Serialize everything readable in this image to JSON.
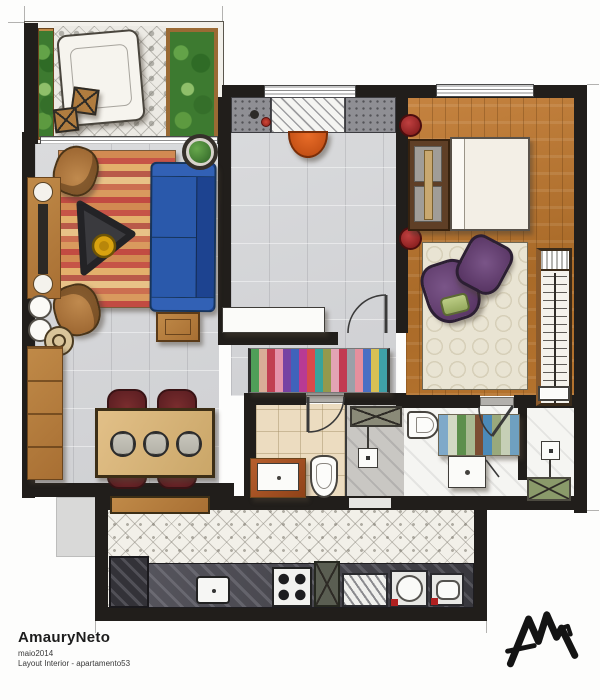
{
  "artwork": {
    "artist": "AmauryNeto",
    "date_line": "maio2014",
    "caption": "Layout Interior - apartamento53"
  },
  "logo": {
    "icon": "am-zigzag-monogram"
  },
  "palette": {
    "walls": "#211e1b",
    "wood_floor": "#b5732e",
    "sofa_blue": "#2a59ab",
    "armchair_tan": "#b27a42",
    "dining_chair_maroon": "#6e2428",
    "bedroom_chair_purple": "#5d3a68",
    "ottoman_green": "#a9bd72",
    "lamp_red": "#8e1f1f",
    "entry_chair_orange": "#d45a1e",
    "bowl_yellow": "#d9a20f",
    "balcony_green": "#3d7a30",
    "paper": "#fdfdfc"
  },
  "rugs": {
    "living_stripes": [
      "#d28a52",
      "#c65447",
      "#e3b06c",
      "#b95a49",
      "#e8c287",
      "#cc6f50",
      "#d99a5e",
      "#c24b42",
      "#d28a52",
      "#c65447",
      "#e3b06c",
      "#b95a49",
      "#e8c287",
      "#cc6f50",
      "#d99a5e",
      "#c24b42",
      "#d28a52",
      "#c65447",
      "#e3b06c",
      "#b95a49",
      "#e8c287",
      "#cc6f50",
      "#d99a5e",
      "#c24b42"
    ],
    "hallway_stripes": [
      "#4f9e58",
      "#d9ad97",
      "#c13f52",
      "#e592ab",
      "#7742a3",
      "#4063ba",
      "#b83a93",
      "#d84a4a",
      "#38a39b",
      "#93994c",
      "#e3a4b4",
      "#c23a52",
      "#9aa0a8",
      "#e58f9d",
      "#4a6fc4",
      "#d9c054",
      "#3fa0a8"
    ],
    "ensuite_stripes": [
      "#7fa9c9",
      "#d3d9c4",
      "#5d8f4c",
      "#a9ba92",
      "#7c4e33",
      "#4c8ab8",
      "#99a97c",
      "#c6cfb6",
      "#6fa0c0"
    ]
  }
}
